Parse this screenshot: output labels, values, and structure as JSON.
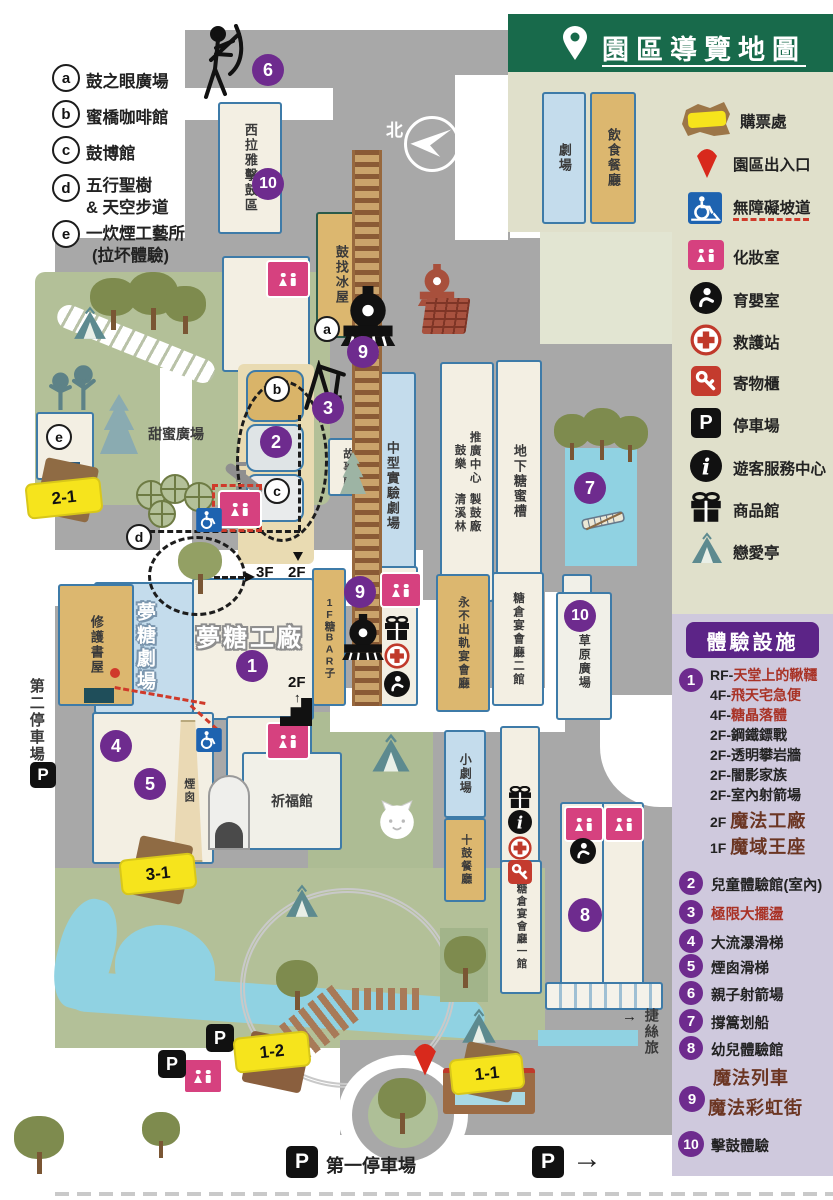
{
  "header": {
    "title": "園區導覽地圖"
  },
  "letter_legend": {
    "a_key": "a",
    "a_label": "鼓之眼廣場",
    "b_key": "b",
    "b_label": "蜜橋咖啡館",
    "c_key": "c",
    "c_label": "鼓博館",
    "d_key": "d",
    "d_line1": "五行聖樹",
    "d_line2": "& 天空步道",
    "e_key": "e",
    "e_line1": "一炊煙工藝所",
    "e_line2": "(拉坏體驗)"
  },
  "legend": {
    "theater": "劇場",
    "restaurant": "飲食餐廳",
    "items": [
      {
        "icon": "ticket-icon",
        "label": "購票處"
      },
      {
        "icon": "entrance-pin-icon",
        "label": "園區出入口"
      },
      {
        "icon": "wheelchair-icon",
        "label": "無障礙坡道"
      },
      {
        "icon": "restroom-icon",
        "label": "化妝室"
      },
      {
        "icon": "nursing-icon",
        "label": "育嬰室"
      },
      {
        "icon": "first-aid-icon",
        "label": "救護站"
      },
      {
        "icon": "locker-key-icon",
        "label": "寄物櫃"
      },
      {
        "icon": "parking-icon",
        "label": "停車場"
      },
      {
        "icon": "info-icon",
        "label": "遊客服務中心"
      },
      {
        "icon": "gift-icon",
        "label": "商品館"
      },
      {
        "icon": "tent-icon",
        "label": "戀愛亭"
      }
    ]
  },
  "panel": {
    "title": "體驗設施",
    "badge1": "1",
    "item1_lines": [
      {
        "pre": "RF-",
        "txt": "天堂上的鞦韆"
      },
      {
        "pre": "4F-",
        "txt": "飛天宅急便"
      },
      {
        "pre": "4F-",
        "txt": "糖晶落體"
      },
      {
        "pre": "2F-",
        "txt": "鋼鐵鏢戰"
      },
      {
        "pre": "2F-",
        "txt": "透明攀岩牆"
      },
      {
        "pre": "2F-",
        "txt": "闇影家族"
      },
      {
        "pre": "2F-",
        "txt": "室內射箭場"
      }
    ],
    "magic1_pre": "2F",
    "magic1_txt": "魔法工廠",
    "magic2_pre": "1F",
    "magic2_txt": "魔域王座",
    "items": [
      {
        "num": "2",
        "label": "兒童體驗館(室內)"
      },
      {
        "num": "3",
        "label": "極限大擺盪"
      },
      {
        "num": "4",
        "label": "大流瀑滑梯"
      },
      {
        "num": "5",
        "label": "煙囪滑梯"
      },
      {
        "num": "6",
        "label": "親子射箭場"
      },
      {
        "num": "7",
        "label": "撐篙划船"
      },
      {
        "num": "8",
        "label": "幼兒體驗館"
      }
    ],
    "item9_num": "9",
    "item9_line1": "魔法列車",
    "item9_line2": "魔法彩虹街",
    "item10_num": "10",
    "item10_label": "擊鼓體驗"
  },
  "map": {
    "north": "北",
    "labels": {
      "xilaya": "西拉雅擊鼓區",
      "ice_house": "鼓找冰屋",
      "story_house": "故事館",
      "mid_theater": "中型實驗劇場",
      "promo_center": "推廣中心",
      "drum_music": "鼓樂",
      "qingxilin": "清溪林",
      "drum_workshop": "製鼓廠",
      "sugar_tank": "地下糖蜜槽",
      "banquet_never": "永不出軌宴會廳",
      "banquet2": "糖倉宴會廳二館",
      "banquet1": "糖倉宴會廳一館",
      "grass_plaza": "草原廣場",
      "small_theater": "小劇場",
      "drum_restaurant": "十鼓餐廳",
      "blessing_hall": "祈福館",
      "dream_theater": "夢糖劇場",
      "dream_factory": "夢糖工廠",
      "sugar_bar": "1F糖BAR子",
      "repair_bookhouse": "修護書屋",
      "sweet_plaza": "甜蜜廣場",
      "chimney": "煙囪",
      "parking2": "第二停車場",
      "parking1": "第一停車場",
      "hotel": "捷絲旅",
      "hotel_arrow": "→",
      "f3": "3F",
      "f2a": "2F",
      "f2b": "2F"
    },
    "tickets": {
      "t21": "2-1",
      "t31": "3-1",
      "t12": "1-2",
      "t11": "1-1"
    },
    "badges": {
      "n1": "1",
      "n2": "2",
      "n3": "3",
      "n4": "4",
      "n5": "5",
      "n6": "6",
      "n7": "7",
      "n8": "8",
      "n9": "9",
      "n10": "10"
    },
    "letters": {
      "a": "a",
      "b": "b",
      "c": "c",
      "d": "d",
      "e": "e"
    },
    "p_label": "P",
    "exit_arrow": "→"
  },
  "colors": {
    "header_green": "#186a4b",
    "panel_purple": "#5c2487",
    "badge_purple": "#6e2b8e",
    "ticket_yellow": "#f6e41c",
    "restroom_pink": "#d6417f",
    "water_blue": "#90d2e2"
  }
}
